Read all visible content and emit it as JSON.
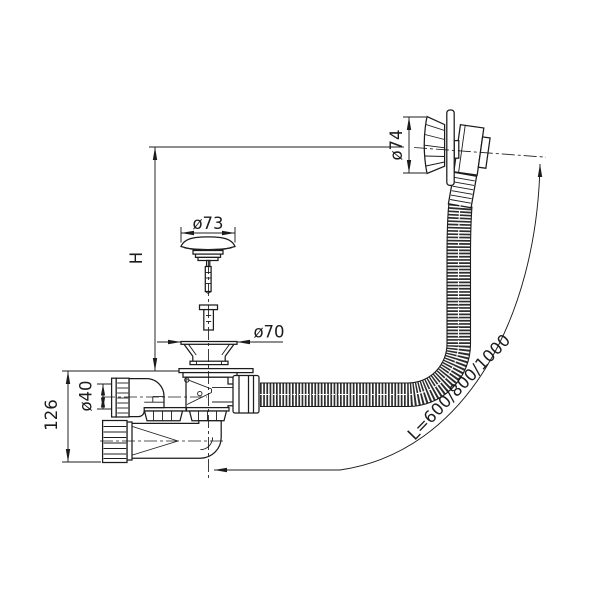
{
  "drawing": {
    "background_color": "#ffffff",
    "line_color": "#1c1c1c",
    "hose_color": "#2e2e2e",
    "labels": {
      "height_ref": "H",
      "trap_height": "126",
      "inlet_diameter": "ø40",
      "plug_diameter": "ø73",
      "strainer_diameter": "ø70",
      "overflow_diameter": "ø74",
      "hose_length": "L=600/800/1000"
    }
  }
}
